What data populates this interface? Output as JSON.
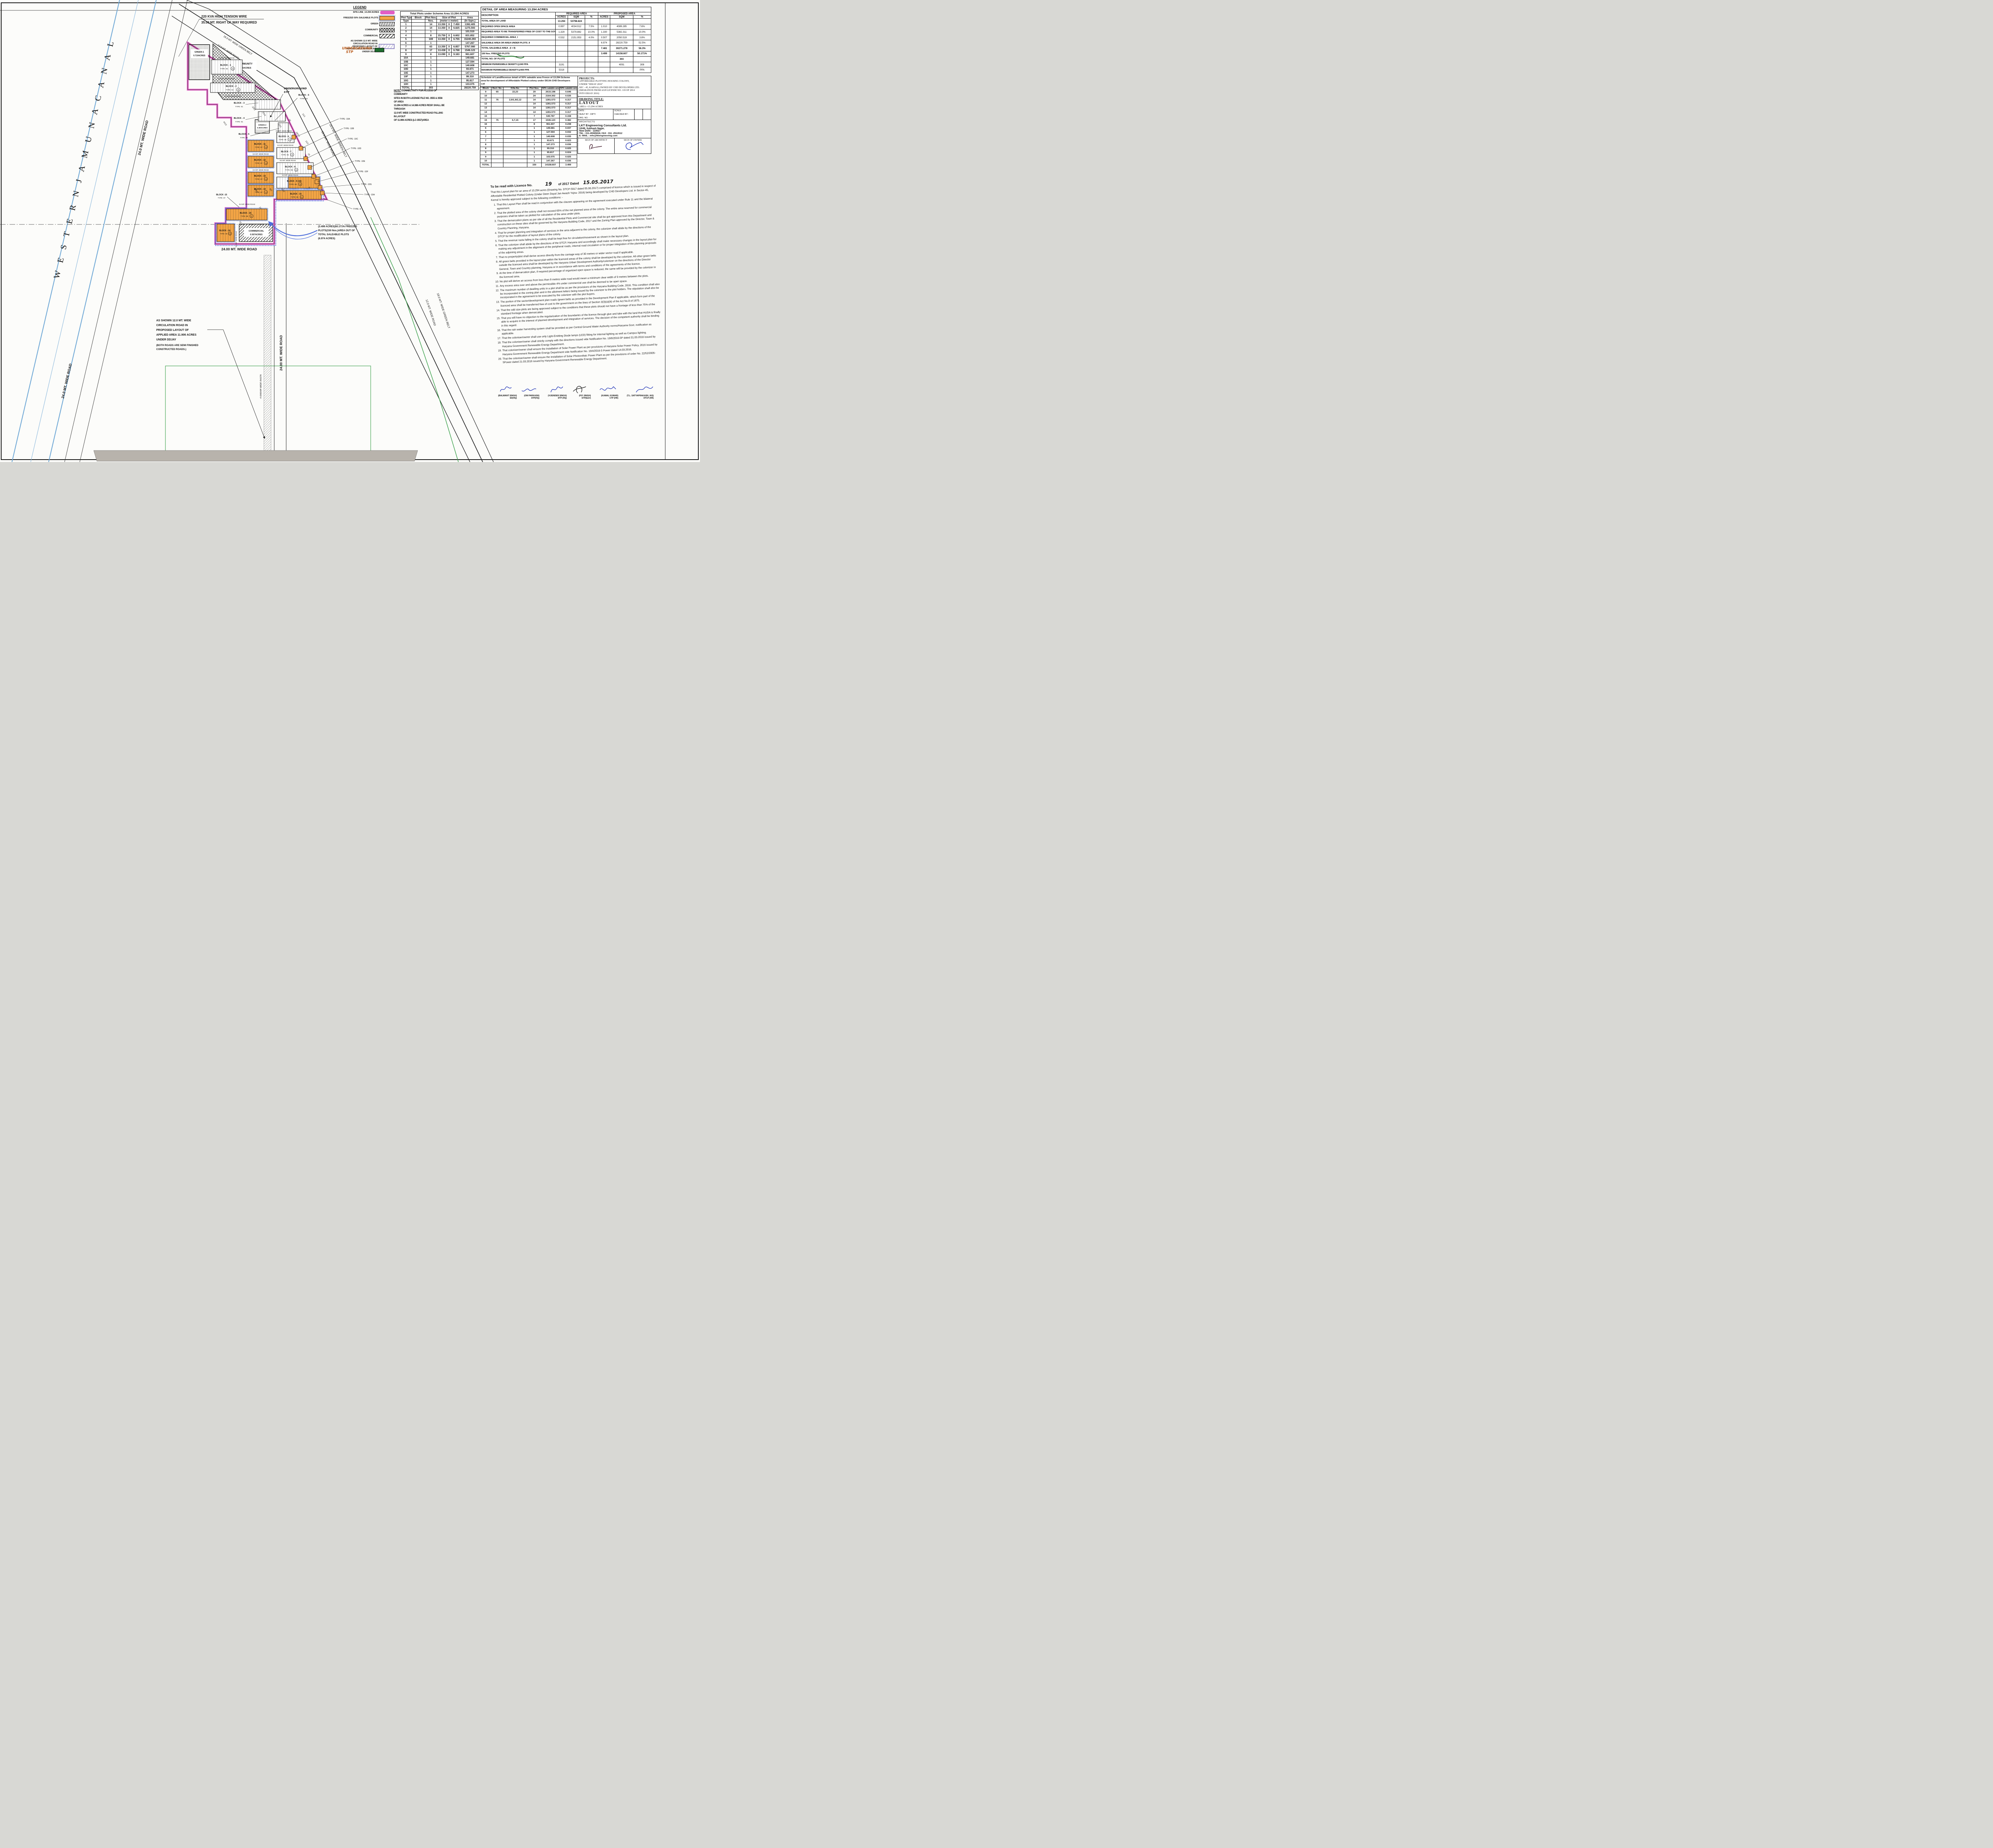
{
  "sheet": {
    "name": "Layout plan drawing sheet - DDJAY 2016 colony, Sec-45 Karnal"
  },
  "plan": {
    "canal": "W E S T E R N   J A M U N A   C A N A L",
    "labels": {
      "road9": "9.0 MT. WIDE ROAD",
      "road24": "24.0 MT. WIDE ROAD",
      "road24b": "24.00 MT. WIDE ROAD",
      "belt16": "16.0 MT. WIDE GREEN BELT",
      "belt18": "18.0 MT. WIDE GREEN BELT",
      "road12": "12.0 MT. WIDE ROAD",
      "kva1": "220 KVA HIGH TENSION WIRE",
      "kva2": "35.00 MT. RIGHT OF WAY REQUIRED",
      "rasta": "4 KARAM WIDE RASTA",
      "stp1": "UNDERGROUND",
      "stp2": "STP"
    },
    "greens": {
      "g1a": "GREEN-1",
      "g1b": "0.710ACRES",
      "g2a": "GREEN-2",
      "g2b": "0.300ACRES",
      "comm1": "COMMUNITY",
      "comm2": "1.33ACRES",
      "com1": "COMMERCIAL",
      "com2": "0.507ACRES"
    },
    "blocks": [
      {
        "name": "BLOCK - 1",
        "type": "TYPE -05",
        "count": "18"
      },
      {
        "name": "BLOCK - 2",
        "type": "TYPE -02",
        "count": "14"
      },
      {
        "name": "BLOCK - 3",
        "type": "TYPE -01",
        "count": ""
      },
      {
        "name": "BLOCK - 4",
        "type": "TYPE -01",
        "count": ""
      },
      {
        "name": "BLOCK - 5",
        "type": "TYPE -04",
        "count": ""
      },
      {
        "name": "BLOCK - 5",
        "type": "TYPE -03",
        "count": ""
      },
      {
        "name": "BLOCK - 6",
        "type": "TYPE -05",
        "count": "18"
      },
      {
        "name": "BLOCK - 7",
        "type": "TYPE -05",
        "count": "26"
      },
      {
        "name": "BLOCK - 8",
        "type": "TYPE -05",
        "count": "38"
      },
      {
        "name": "BLOCK - 9 (16)",
        "type": "TYPE -05",
        "count": "23"
      },
      {
        "name": "BLOCK - 10",
        "type": "TYPE -05",
        "count": "24"
      },
      {
        "name": "BLOCK - 11",
        "type": "TYPE -07",
        "count": "14"
      },
      {
        "name": "BLOCK - 12",
        "type": "TYPE -07",
        "count": "14"
      },
      {
        "name": "BLOCK - 13",
        "type": "TYPE -07",
        "count": "14"
      },
      {
        "name": "BLOCK - 14",
        "type": "TYPE -07",
        "count": "14"
      },
      {
        "name": "BLOCK - 15",
        "type": "TYPE -08",
        "count": "17"
      },
      {
        "name": "BLOCK - 16",
        "type": "TYPE -09",
        "count": "08"
      },
      {
        "name": "BLOCK -15",
        "type": "TYPE -07",
        "count": ""
      }
    ],
    "type10": [
      "TYPE -10A",
      "TYPE -10B",
      "TYPE -10C",
      "TYPE -10D",
      "TYPE -10E",
      "TYPE -10F",
      "TYPE -10G",
      "TYPE -10H",
      "TYPE -6"
    ],
    "revenue": [
      "8/1",
      "3/2/2",
      "3/1/2",
      "4/1/2",
      "22/2",
      "20",
      "16/1/1",
      "21/1",
      "21/2",
      "15",
      "9/2",
      "10/2",
      "1/6/1",
      "6",
      "23",
      "22"
    ],
    "freeze_note": [
      "(3.499 ACRES)50.171% FREEZED",
      "PLOTS(150 Nos.)AREA OUT OF",
      "TOTAL SALEABLE PLOTS",
      "(6.974 ACRES)"
    ],
    "circ_note": [
      "AS SHOWN 12.0 MT. WIDE",
      "CIRCULATION ROAD IN",
      "PROPOSED LAYOUT OF",
      "APPLIED AREA 11.906 ACRES",
      "UNDER DDJAY",
      "(BOTH ROADS ARE SEMI FINISHED",
      "CONSTRUCTED ROADS.)"
    ]
  },
  "legend": {
    "title": "LEGEND",
    "items": [
      {
        "lines": [
          "SITE LINE_13.294 ACRES"
        ],
        "swatch": "siteline"
      },
      {
        "lines": [
          "FREEZED 50% SALEABLE PLOTS"
        ],
        "swatch": "freezed"
      },
      {
        "lines": [
          "GREEN"
        ],
        "swatch": "green"
      },
      {
        "lines": [
          "COMMUNITY"
        ],
        "swatch": "community"
      },
      {
        "lines": [
          "COMMERCIAL"
        ],
        "swatch": "commercial"
      },
      {
        "lines": [
          "AS SHOWN 12.0 MT. WIDE",
          "CIRCULATION ROAD IN",
          "PROPOSED LAYOUT OF",
          "APPLIED AREA 11.906 ACRES",
          "UNDER DDJAY"
        ],
        "swatch": "circ"
      }
    ],
    "stp_hand": [
      "UNDERGROUND",
      "STP"
    ]
  },
  "plots_table": {
    "title": "Total Plots under Scheme Area 13.294 ACRES",
    "headers": {
      "type": "Plot Type",
      "block": "Block",
      "nos": "Plot Nos.",
      "size": "Size of Plot",
      "size2": "(meter x meter)",
      "area": "Area",
      "area2": "(In Sqm.)"
    },
    "rows": [
      {
        "type": "1",
        "nos": "14",
        "w": "13.350",
        "h": "7.450",
        "area": "1392.405"
      },
      {
        "type": "2",
        "nos": "14",
        "w": "13.350",
        "h": "6.825",
        "area": "1275.593"
      },
      {
        "type": "3",
        "nos": "1",
        "w": "",
        "h": "",
        "area": "101.510"
      },
      {
        "type": "4",
        "nos": "8",
        "w": "15.750",
        "h": "6.602",
        "area": "831.852"
      },
      {
        "type": "5",
        "nos": "169",
        "w": "13.350",
        "h": "6.755",
        "area": "15240.293"
      },
      {
        "type": "6",
        "nos": "1",
        "w": "",
        "h": "",
        "area": "147.267"
      },
      {
        "type": "7",
        "nos": "63",
        "w": "13.350",
        "h": "6.857",
        "area": "5767.080"
      },
      {
        "type": "8",
        "nos": "17",
        "w": "13.438",
        "h": "6.768",
        "area": "1546.123"
      },
      {
        "type": "9",
        "nos": "8",
        "w": "13.090",
        "h": "9.183",
        "area": "961.607"
      },
      {
        "type": "10A",
        "nos": "1",
        "w": "",
        "h": "",
        "area": "149.681"
      },
      {
        "type": "10B",
        "nos": "1",
        "w": "",
        "h": "",
        "area": "127.594"
      },
      {
        "type": "10C",
        "nos": "1",
        "w": "",
        "h": "",
        "area": "140.608"
      },
      {
        "type": "10D",
        "nos": "1",
        "w": "",
        "h": "",
        "area": "93.671"
      },
      {
        "type": "10E",
        "nos": "1",
        "w": "",
        "h": "",
        "area": "147.273"
      },
      {
        "type": "10F",
        "nos": "1",
        "w": "",
        "h": "",
        "area": "99.310"
      },
      {
        "type": "10G",
        "nos": "1",
        "w": "",
        "h": "",
        "area": "95.817"
      },
      {
        "type": "10H",
        "nos": "1",
        "w": "",
        "h": "",
        "area": "103.075"
      },
      {
        "type": "TOTAL",
        "nos": "303",
        "w": "",
        "h": "",
        "area": "28220.759"
      }
    ]
  },
  "note": [
    "NOTE : CONNECTIVITY FOR ACCESS OF COMMUNITY",
    "SITES IN BOTH LICENSE FILE NO. 3555 & 3556 OF AREA",
    "13.294 ACRES & 14.388 ACRES RESP. SHALL BE THROUGH",
    "12.0 MT. WIDE CONSTRUCTED ROAD FALLING IN LAYOUT",
    "OF 11.906 ACRES (LC-3557)AREA"
  ],
  "detail_table": {
    "title": "DETAIL OF AREA MEASURING 13.294 ACRES",
    "desc_header": "DESCRIPTION",
    "group1": "REQUIRED AREA",
    "group2": "PROPOSED AREA",
    "sub": [
      "ACRES",
      "SQM",
      "%"
    ],
    "rows": [
      {
        "desc": "TOTAL AREA OF LAND",
        "c": [
          "13.294",
          "53798.824",
          "",
          "",
          "",
          ""
        ],
        "bold": true
      },
      {
        "desc": "REQUIRED OPEN SPACE AREA",
        "c": [
          "0.997",
          "4034.912",
          "7.5%",
          "1.010",
          "4089.285",
          "7.6%"
        ]
      },
      {
        "desc": "REQUIRED AREA TO BE TRANSFERRED FREE OF COST TO THE GOVERNMENT",
        "c": [
          "1.329",
          "5379.882",
          "10.0%",
          "1.330",
          "5382.311",
          "10.0%"
        ]
      },
      {
        "desc": "REQUIRED COMMERCIAL AREA_I",
        "c": [
          "0.532",
          "2151.953",
          "4.0%",
          "0.507",
          "2050.519",
          "3.8%"
        ]
      },
      {
        "desc": "SALEABLE AREA OR AREA UNDER PLOTS_II",
        "c": [
          "",
          "",
          "",
          "6.974",
          "28220.759",
          "52.5%"
        ]
      },
      {
        "desc": "TOTAL SALEABLE AREA _(I + II)",
        "c": [
          "",
          "",
          "",
          "7.481",
          "30271.278",
          "56.3%"
        ],
        "bold": true
      },
      {
        "desc": "150 Nos. FREEZED PLOTS",
        "c": [
          "",
          "",
          "",
          "3.499",
          "14158.607",
          "50.171%"
        ],
        "bold": true
      },
      {
        "desc": "TOTAL NO. OF PLOTS",
        "c": [
          "",
          "",
          "",
          "",
          "303",
          ""
        ],
        "bold": true
      },
      {
        "desc": "MINIMUM PERMISSIBLE DENSITY@240 PPA",
        "c": [
          "3191",
          "",
          "",
          "",
          "4091",
          "308"
        ]
      },
      {
        "desc": "MAXIMUM PERMISSIBLE DENSITY@400 PPA",
        "c": [
          "5318",
          "",
          "",
          "",
          "",
          "PPA"
        ]
      }
    ]
  },
  "schedule": {
    "heading": [
      "Schedule of Land/Revenue detail of 50% saleable area Freeze of 13.294 Scheme",
      "area for development of Affordable Plotted colony under DDJA-CHD Developers",
      "Ltd"
    ],
    "headers": [
      "Block",
      "Rect. No.",
      "Killa No.",
      "Plot Nos.",
      "50% salable area in Sqm",
      "50% salable area in Acre"
    ],
    "rows": [
      [
        "9",
        "65",
        "22,23",
        "29",
        "2615.198",
        "0.646"
      ],
      [
        "10",
        "",
        "",
        "24",
        "2164.302",
        "0.535"
      ],
      [
        "11",
        "76",
        "2,9/1,9/2,12",
        "14",
        "1281.573",
        "0.317"
      ],
      [
        "12",
        "",
        "",
        "14",
        "1281.573",
        "0.317"
      ],
      [
        "13",
        "",
        "",
        "14",
        "1281.573",
        "0.317"
      ],
      [
        "14",
        "",
        "",
        "14",
        "1281.573",
        "0.317"
      ],
      [
        "15",
        "",
        "",
        "7",
        "640.787",
        "0.158"
      ],
      [
        "15",
        "75",
        "6,7,15",
        "17",
        "1546.123",
        "0.382"
      ],
      [
        "16",
        "",
        "",
        "8",
        "961.607",
        "0.238"
      ],
      [
        "6",
        "",
        "",
        "1",
        "149.681",
        "0.037"
      ],
      [
        "6",
        "",
        "",
        "1",
        "127.594",
        "0.032"
      ],
      [
        "7",
        "",
        "",
        "1",
        "140.608",
        "0.035"
      ],
      [
        "7",
        "",
        "",
        "1",
        "93.671",
        "0.023"
      ],
      [
        "8",
        "",
        "",
        "1",
        "147.273",
        "0.036"
      ],
      [
        "8",
        "",
        "",
        "1",
        "99.310",
        "0.025"
      ],
      [
        "9",
        "",
        "",
        "1",
        "95.817",
        "0.024"
      ],
      [
        "9",
        "",
        "",
        "1",
        "103.075",
        "0.025"
      ],
      [
        "10",
        "",
        "",
        "1",
        "147.267",
        "0.036"
      ],
      [
        "TOTAL",
        "",
        "",
        "150",
        "14158.607",
        "3.499"
      ]
    ]
  },
  "title_block": {
    "projects_label": "PROJECTS:",
    "projects_lines": [
      "AFFORDABLE PLOTTING HOUSING COLONY,",
      "UNDER \"DDJAY 2016\"",
      "SEC - 45, KARNAL,OWNED BY CHD DEVELOPERS LTD.",
      "(MIGRATION FROM AGH LICENSE NO. 119 OF 2014",
      "INTO DDJAY 2016)"
    ],
    "drawing_title_label": "DRAWING TITLE:",
    "drawing_title": "LAYOUT",
    "area_line": "AREA =13.294 ACRES",
    "date": "DATE            :",
    "dealt": "DEALT BY  : DIPTI",
    "drg": "DRG. NO.   :",
    "scale": "SCALE                :",
    "checked": "CHECKED BY      :",
    "architects_label": "ARCHITECTS",
    "firm": "LKT Engineering Consultants Ltd.",
    "addr1": "10/49, Subhash Nagar,",
    "addr2": "New Delhi - 110027",
    "tel": "TEL : 011-45565818, FAX : 011 -2512612",
    "email": "E- MAIL : info@lktengineering.com",
    "sign_architect": "SIGN OF ARCHITECT",
    "sign_owner": "SIGN OF OWNER"
  },
  "licence": {
    "head1": "To be read with Licence No.",
    "no_hand": "19",
    "head2": "of 2017  Dated",
    "date_hand": "15.05.2017",
    "intro": "That this Layout plan for an area of 13.294 acres (Drawing No. DTCP-5917 dated 05.06.2017) comprised of licence which is issued in respect of Affordable Residential Plotted Colony (Under Deen Dayal Jan Awash Yojna- 2016) being developed by CHD Developers Ltd. in Sector-45, Karnal is hereby approved subject to the following conditions: -",
    "conditions": [
      "That this Layout Plan shall be read in conjunction with the clauses appearing on the agreement executed under Rule 11 and the bilateral agreement.",
      "That the plotted area of the colony shall not exceed 65% of the net planned area of the colony. The entire area reserved for commercial purposes shall be taken as plotted for calculation of the area under plots.",
      "That the demarcation plans as per site of all the Residential Plots and Commercial site shall be got approved from this Department and construction on these sites shall be governed by the Haryana Building Code, 2017 and the Zoning Plan approved by the Director, Town & Country Planning, Haryana.",
      "That for proper planning and integration of services in the area adjacent to the colony, the colonizer shall abide by the directions of the DTCP for the modification of layout plans of the colony.",
      "That the revenue rasta falling in the colony shall be kept free for circulation/movement as shown in the layout plan.",
      "That the colonizer shall abide by the directions of the DTCP, Haryana and accordingly shall make necessary changes in the layout plan for making any adjustment in the alignment of the peripheral roads, internal road circulation or for proper integration of the planning proposals of the adjoining areas.",
      "That no property/plot shall derive access directly from the carriage way of 30 metres or wider sector road if applicable.",
      "All green belts provided in the layout plan within the licenced areas of the colony shall be developed by the colonizer. All other green belts outside the licenced area shall be developed by the Haryana Urban Development Authority/colonizer on the directions of the Director General, Town and Country planning, Haryana or in accordance with terms and conditions of the agreements of the licence.",
      "At the time of demarcation plan, if required percentage of organized open space is reduced, the same will be provided by the colonizer in the licenced area.",
      "No plot will derive an access from less than 9 metres wide road would mean a minimum clear width of 9 metres between the plots.",
      "Any excess area over and above the permissible 4% under commercial use shall be deemed to be open space.",
      "The maximum number of dwelling units in a plot shall be as per the provisions of the Haryana Building Code, 2016. This condition shall also be incorporated in the zoning plan and in the allotment letters being issued by the colonizer to the plot holders. The stipulation shall also be incorporated in the agreement to be executed by the colonizer with the plot buyers.",
      "The portion of the sector/development plan roads /green belts as provided in the Development Plan if applicable, which form part of the licenced area shall be transferred free of cost to the government on the lines of Section 3(3)(a)(iii) of the Act No.8 of 1975.",
      "That the odd size plots are being approved subject to the conditions that these plots should not have a frontage of less than 75% of the standard frontage when demarcated.",
      "That you will have no objection to the regularization of the boundaries of the licence through give and take with the land that HUDA is finally able to acquire in the interest of planned development and integration of services. The decision of the competent authority shall be binding in this regard.",
      "That the rain water harvesting system shall be provided as per Central Ground Water Authority norms/Haryana Govt. notification as applicable.",
      "That the coloniser/owner shall use only Light-Emitting Diode lamps (LED) fitting for internal lighting as well as Campus lighting.",
      "That the coloniser/owner shall strictly comply with the directions issued vide Notification No. 19/6/2016-5P dated 31.03.2016 issued by Haryana Government Renewable Energy Department.",
      "That coloniser/owner shall ensure the installation of Solar Power Plant as per provisions of Haryana Solar Power Policy, 2016 issued by Haryana Government Renewable Energy Department vide Notification No. 19/4/2016-5 Power dated 14.03.2016.",
      "That the coloniser/owner shall ensure the installation of Solar Photovoltaic Power Plant as per the provisions of order No. 22/52/2005-5Power dated 21.03.2016 issued by Haryana Government Renewable Energy Department."
    ]
  },
  "signatories": [
    {
      "name": "(BALWANT SINGH)",
      "role": "SD(HQ)"
    },
    {
      "name": "(OM PARKASH)",
      "role": "ATP(HQ)"
    },
    {
      "name": "(VIJENDER SINGH)",
      "role": "DTP (HQ)"
    },
    {
      "name": "(P.P. SINGH)",
      "role": "STP(E&V)"
    },
    {
      "name": "(KAMAL KUMAR)",
      "role": "CTP (HR)"
    },
    {
      "name": "(T.L. SATYAPRAKASH, IAS)",
      "role": "DTCP (HR)"
    }
  ],
  "colors": {
    "siteline": "#e25ec4",
    "freezed_fill": "#f2a445",
    "scallop_blue": "#4f6fdc",
    "green_line": "#3aa04a",
    "hand_orange": "#b85a1a",
    "sig_blue": "#2438b8"
  }
}
